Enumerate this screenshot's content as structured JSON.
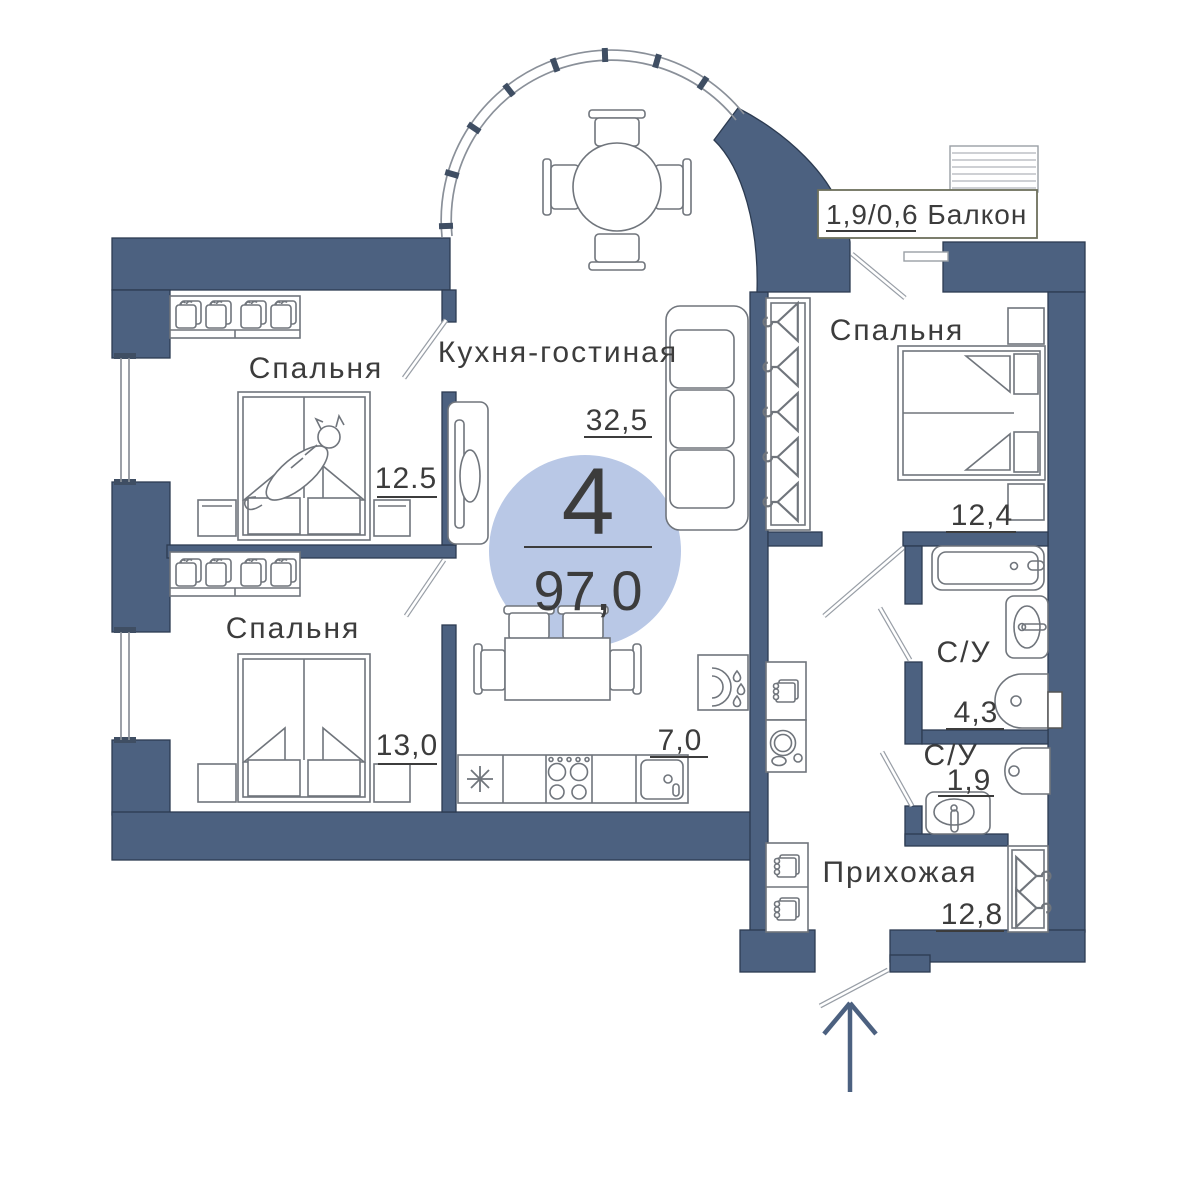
{
  "plan": {
    "badge": {
      "rooms_count": "4",
      "total_area": "97,0"
    },
    "balcony": {
      "label": "1,9/0,6 Балкон"
    },
    "rooms": {
      "bedroom_top_left": {
        "name": "Спальня",
        "area": "12.5"
      },
      "bedroom_bottom_left": {
        "name": "Спальня",
        "area": "13,0"
      },
      "kitchen_living": {
        "name": "Кухня-гостиная",
        "area": "32,5"
      },
      "kitchen_zone": {
        "area": "7,0"
      },
      "bedroom_right": {
        "name": "Спальня",
        "area": "12,4"
      },
      "bathroom_large": {
        "name": "С/У",
        "area": "4,3"
      },
      "bathroom_small": {
        "name": "С/У",
        "area": "1,9"
      },
      "hallway": {
        "name": "Прихожая",
        "area": "12,8"
      }
    },
    "colors": {
      "wall": "#4c6180",
      "wall_dark": "#3f4e63",
      "badge_circle": "#b9c8e6",
      "outline": "#70757c",
      "text": "#3c3c3c"
    }
  }
}
